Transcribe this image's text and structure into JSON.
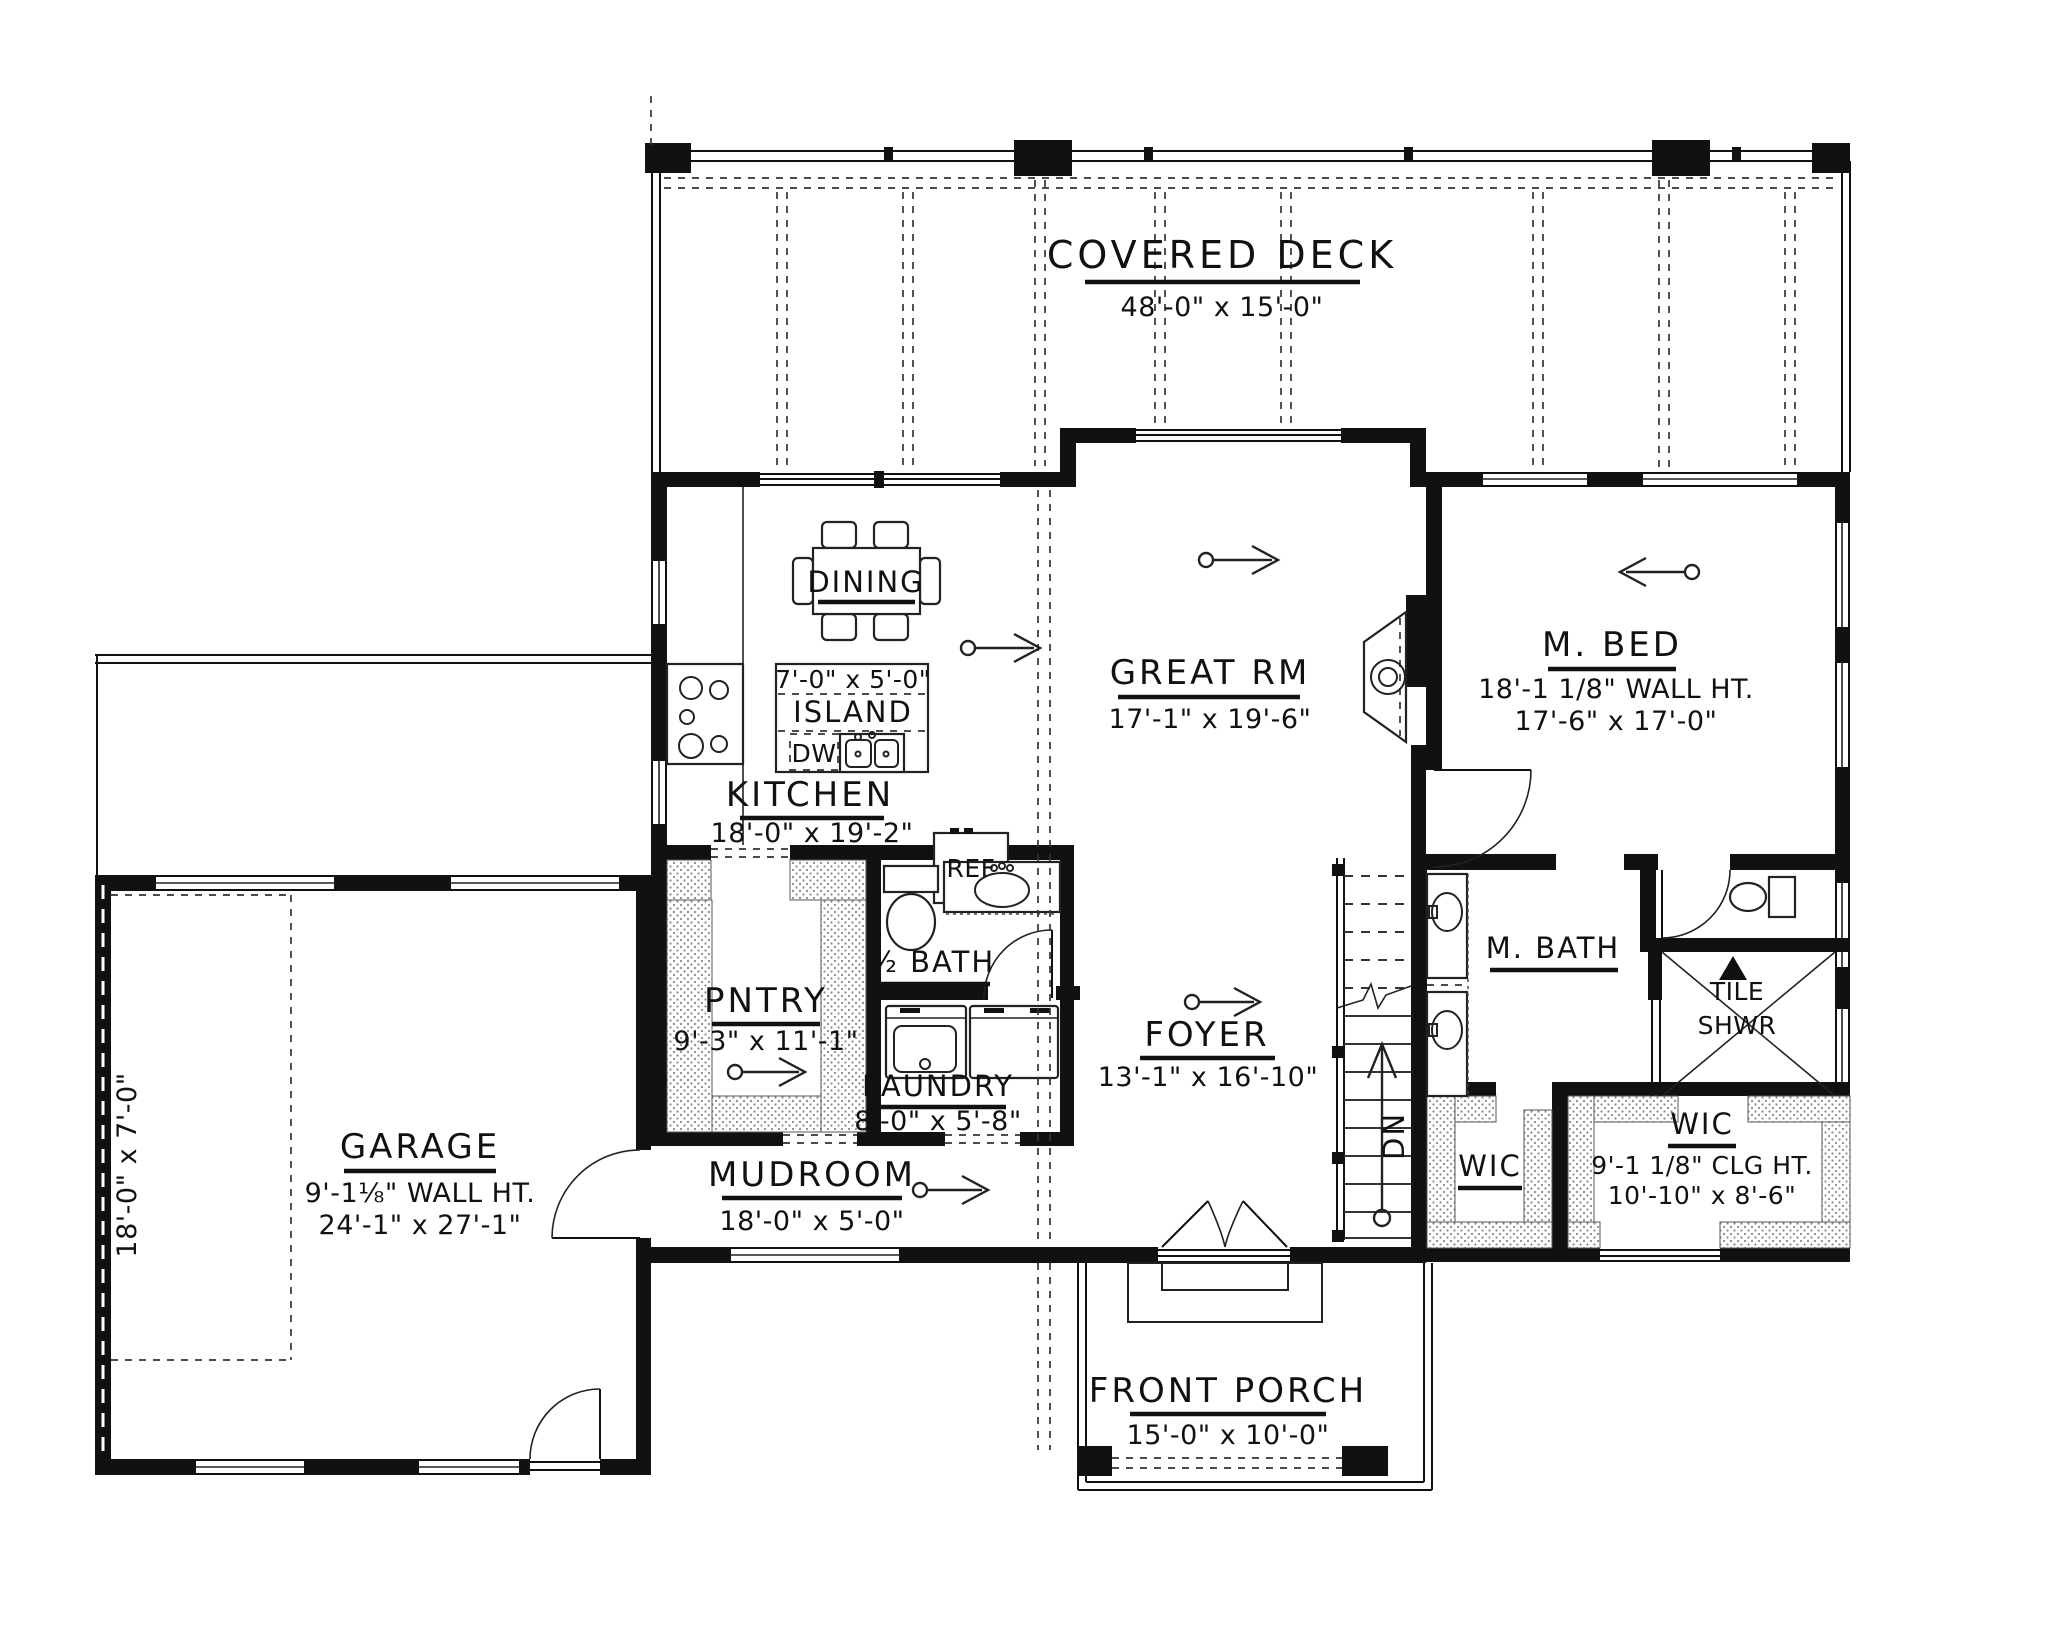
{
  "colors": {
    "ink": "#111111",
    "background": "#ffffff",
    "hatch_dot": "#8a8a8a"
  },
  "plan": {
    "rooms": {
      "covered_deck": {
        "name": "COVERED DECK",
        "dims": "48'-0\" x 15'-0\""
      },
      "dining": {
        "name": "DINING"
      },
      "island": {
        "dims": "7'-0\" x 5'-0\"",
        "name": "ISLAND"
      },
      "dishwasher": {
        "name": "DW"
      },
      "kitchen": {
        "name": "KITCHEN",
        "dims": "18'-0\" x 19'-2\""
      },
      "refrigerator": {
        "name": "REF"
      },
      "great_room": {
        "name": "GREAT RM",
        "dims": "17'-1\" x 19'-6\""
      },
      "master_bed": {
        "name": "M. BED",
        "wall_ht": "18'-1 1/8\" WALL HT.",
        "dims": "17'-6\" x 17'-0\""
      },
      "pantry": {
        "name": "PNTRY",
        "dims": "9'-3\" x 11'-1\""
      },
      "half_bath": {
        "name": "½ BATH"
      },
      "laundry": {
        "name": "LAUNDRY",
        "dims": "8'-0\" x 5'-8\""
      },
      "foyer": {
        "name": "FOYER",
        "dims": "13'-1\" x 16'-10\""
      },
      "stairs": {
        "direction": "DN"
      },
      "master_bath": {
        "name": "M. BATH"
      },
      "tile_shower": {
        "line1": "TILE",
        "line2": "SHWR"
      },
      "wic_left": {
        "name": "WIC"
      },
      "wic_right": {
        "name": "WIC",
        "clg_ht": "9'-1 1/8\" CLG HT.",
        "dims": "10'-10\" x 8'-6\""
      },
      "mudroom": {
        "name": "MUDROOM",
        "dims": "18'-0\" x 5'-0\""
      },
      "garage": {
        "name": "GARAGE",
        "wall_ht": "9'-1⅛\" WALL HT.",
        "dims": "24'-1\" x 27'-1\"",
        "side_bay_dims": "18'-0\" x 7'-0\""
      },
      "front_porch": {
        "name": "FRONT PORCH",
        "dims": "15'-0\" x 10'-0\""
      }
    }
  }
}
